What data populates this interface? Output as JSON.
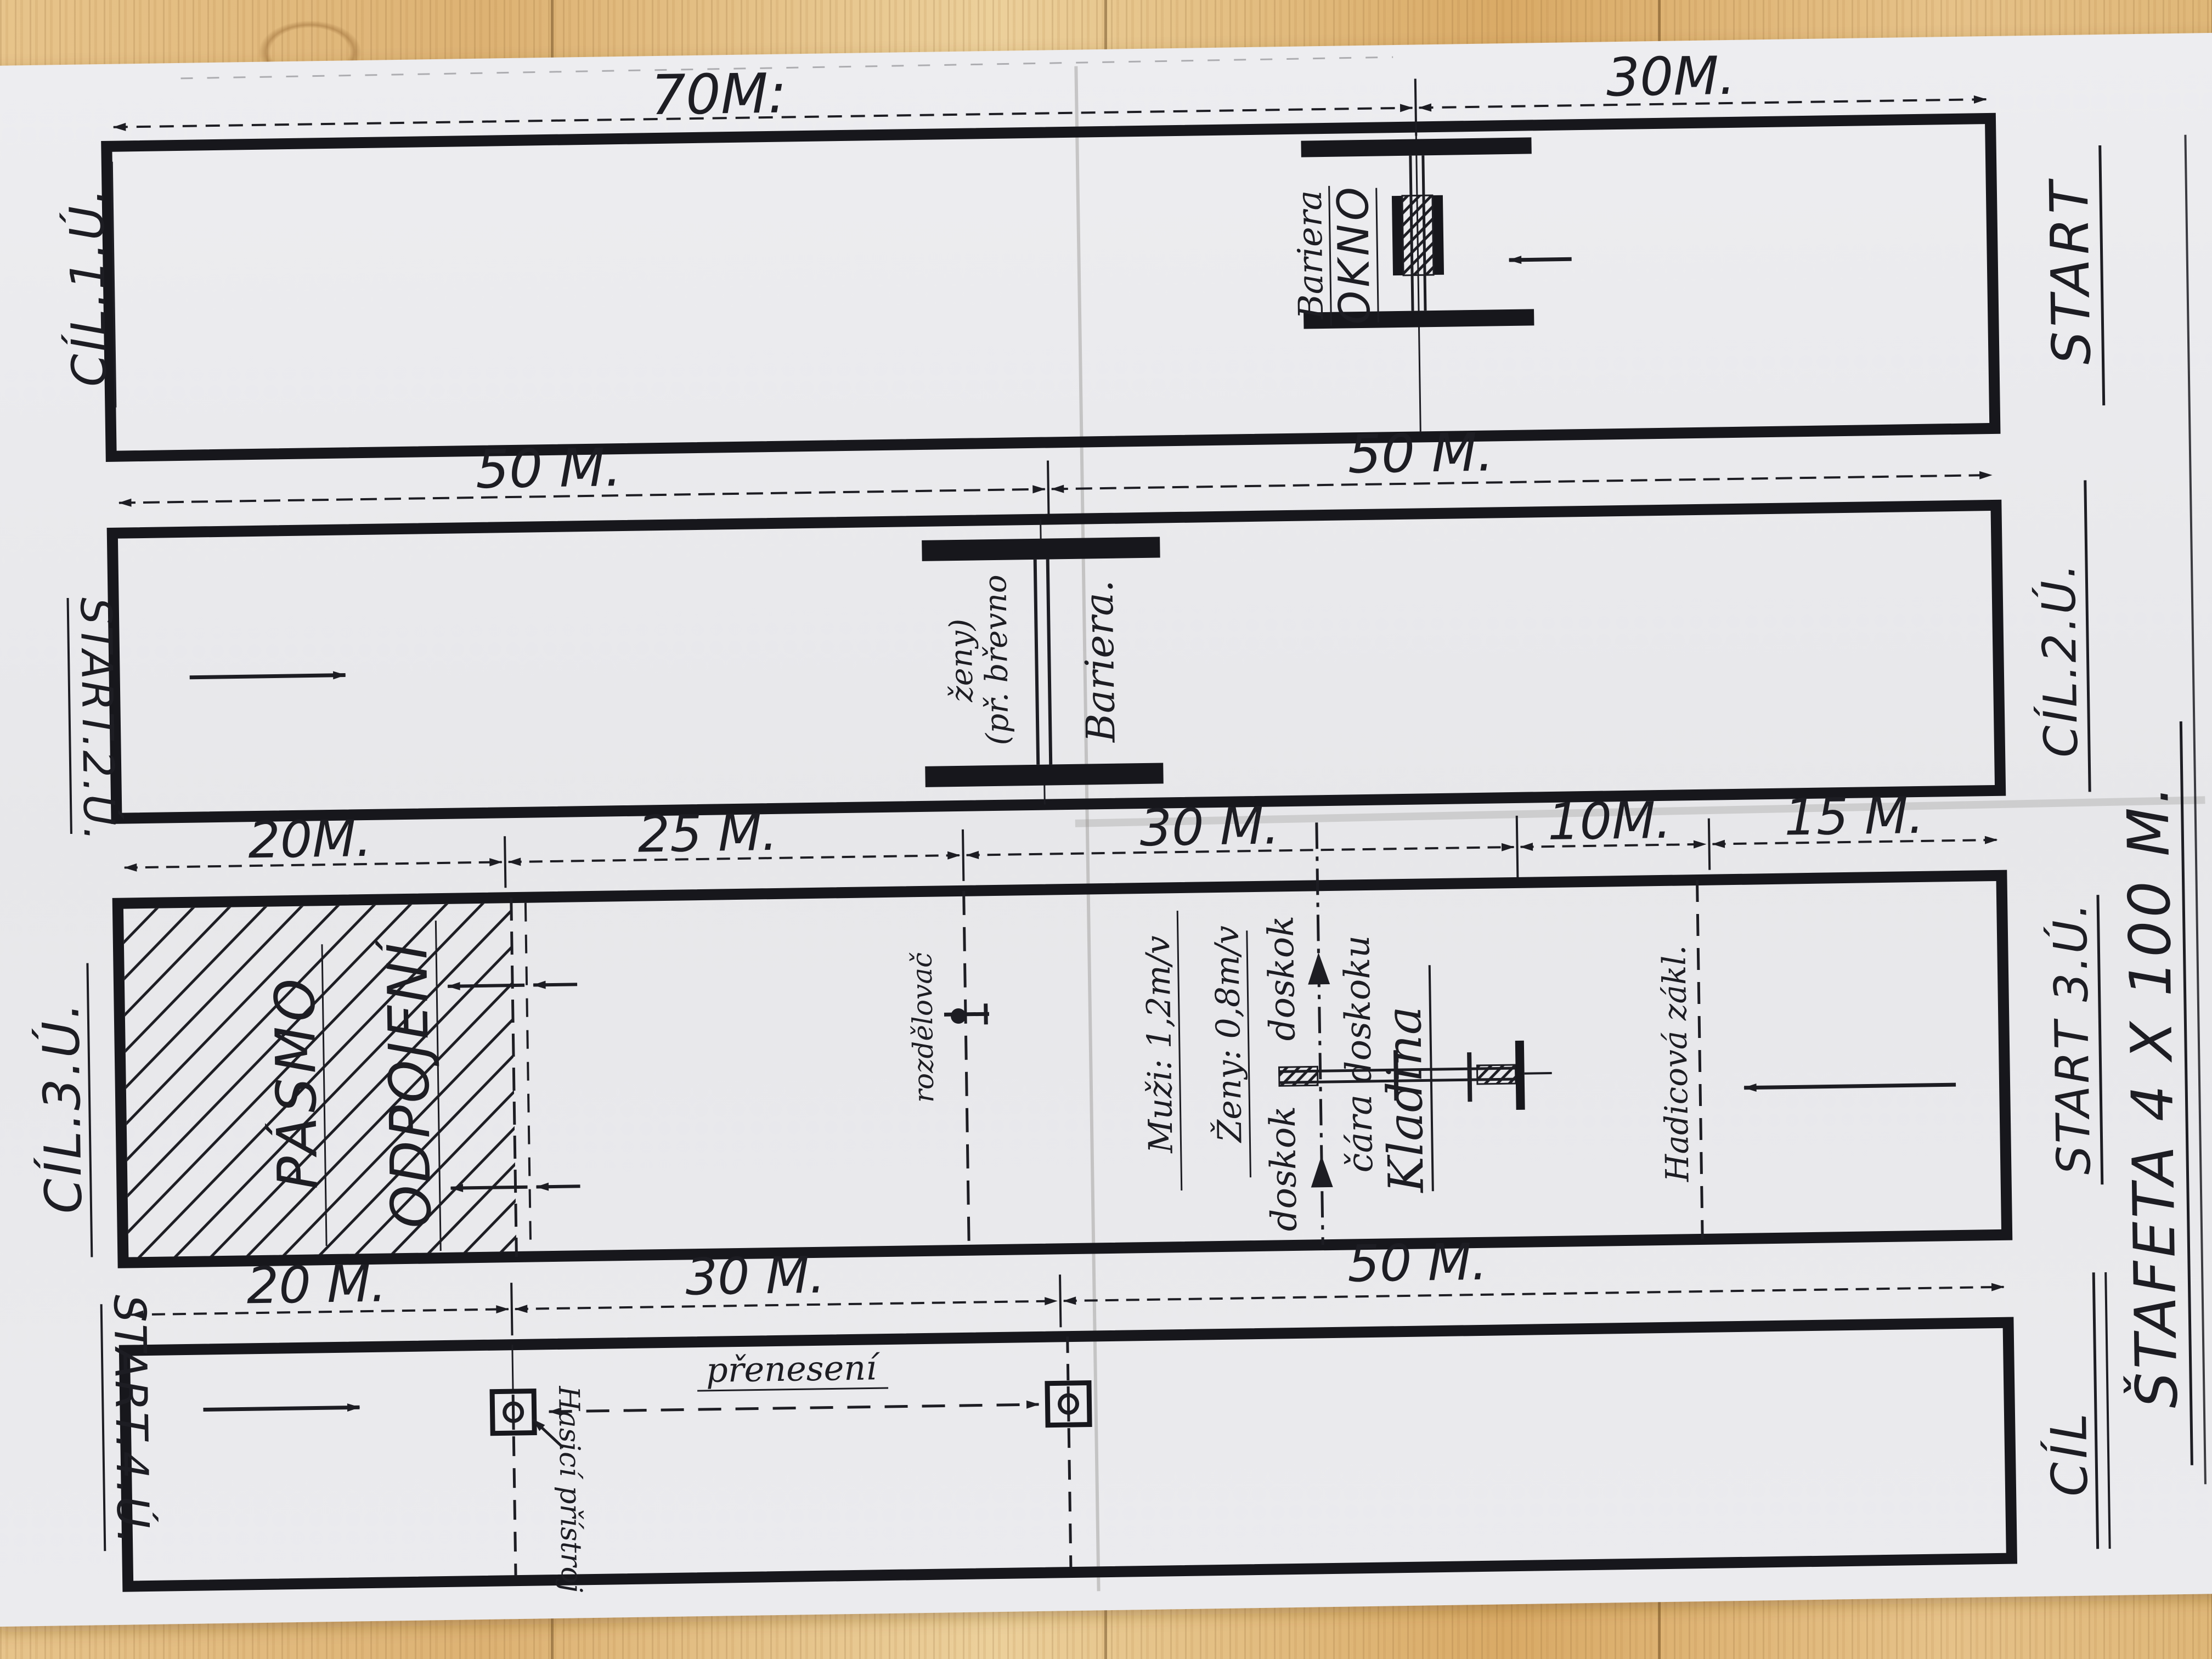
{
  "colors": {
    "ink": "#1d1d23",
    "paper": "#e9e9ec",
    "wood": "#e3bd82"
  },
  "dims": {
    "row1": [
      "70M:",
      "30M."
    ],
    "row2": [
      "50 M.",
      "50 M."
    ],
    "row3": [
      "20M.",
      "25 M.",
      "30 M.",
      "10M.",
      "15 M."
    ],
    "row4": [
      "20 M.",
      "30 M.",
      "50 M."
    ]
  },
  "margins": {
    "left": [
      "CÍL.1.Ú.",
      "START.2.Ú.",
      "CÍL.3.Ú.",
      "START.4.Ú."
    ],
    "right": [
      "START",
      "CÍL.2.Ú.",
      "START 3.Ú.",
      "CÍL"
    ],
    "title": "ŠTAFETA 4 X 100 M."
  },
  "lane1": {
    "bariera": "Bariera",
    "okno": "OKNO"
  },
  "lane2": {
    "bariera": "Bariera.",
    "note_line1": "(př. břevno",
    "note_line2": "ženy)"
  },
  "lane3": {
    "pasmo": "PÁSMO",
    "odpojeni": "ODPOJENÍ",
    "rozdelovac": "rozdělovač",
    "muzi": "Muži: 1,2m/v",
    "zeny": "Ženy: 0,8m/v",
    "doskok_top": "doskok",
    "doskok_bottom": "doskok",
    "cara_doskoku": "čára doskoku",
    "kladina": "Kladina",
    "hadicova": "Hadicová zákl."
  },
  "lane4": {
    "hasici": "Hasicí přístroj",
    "preneseni": "přenesení"
  }
}
